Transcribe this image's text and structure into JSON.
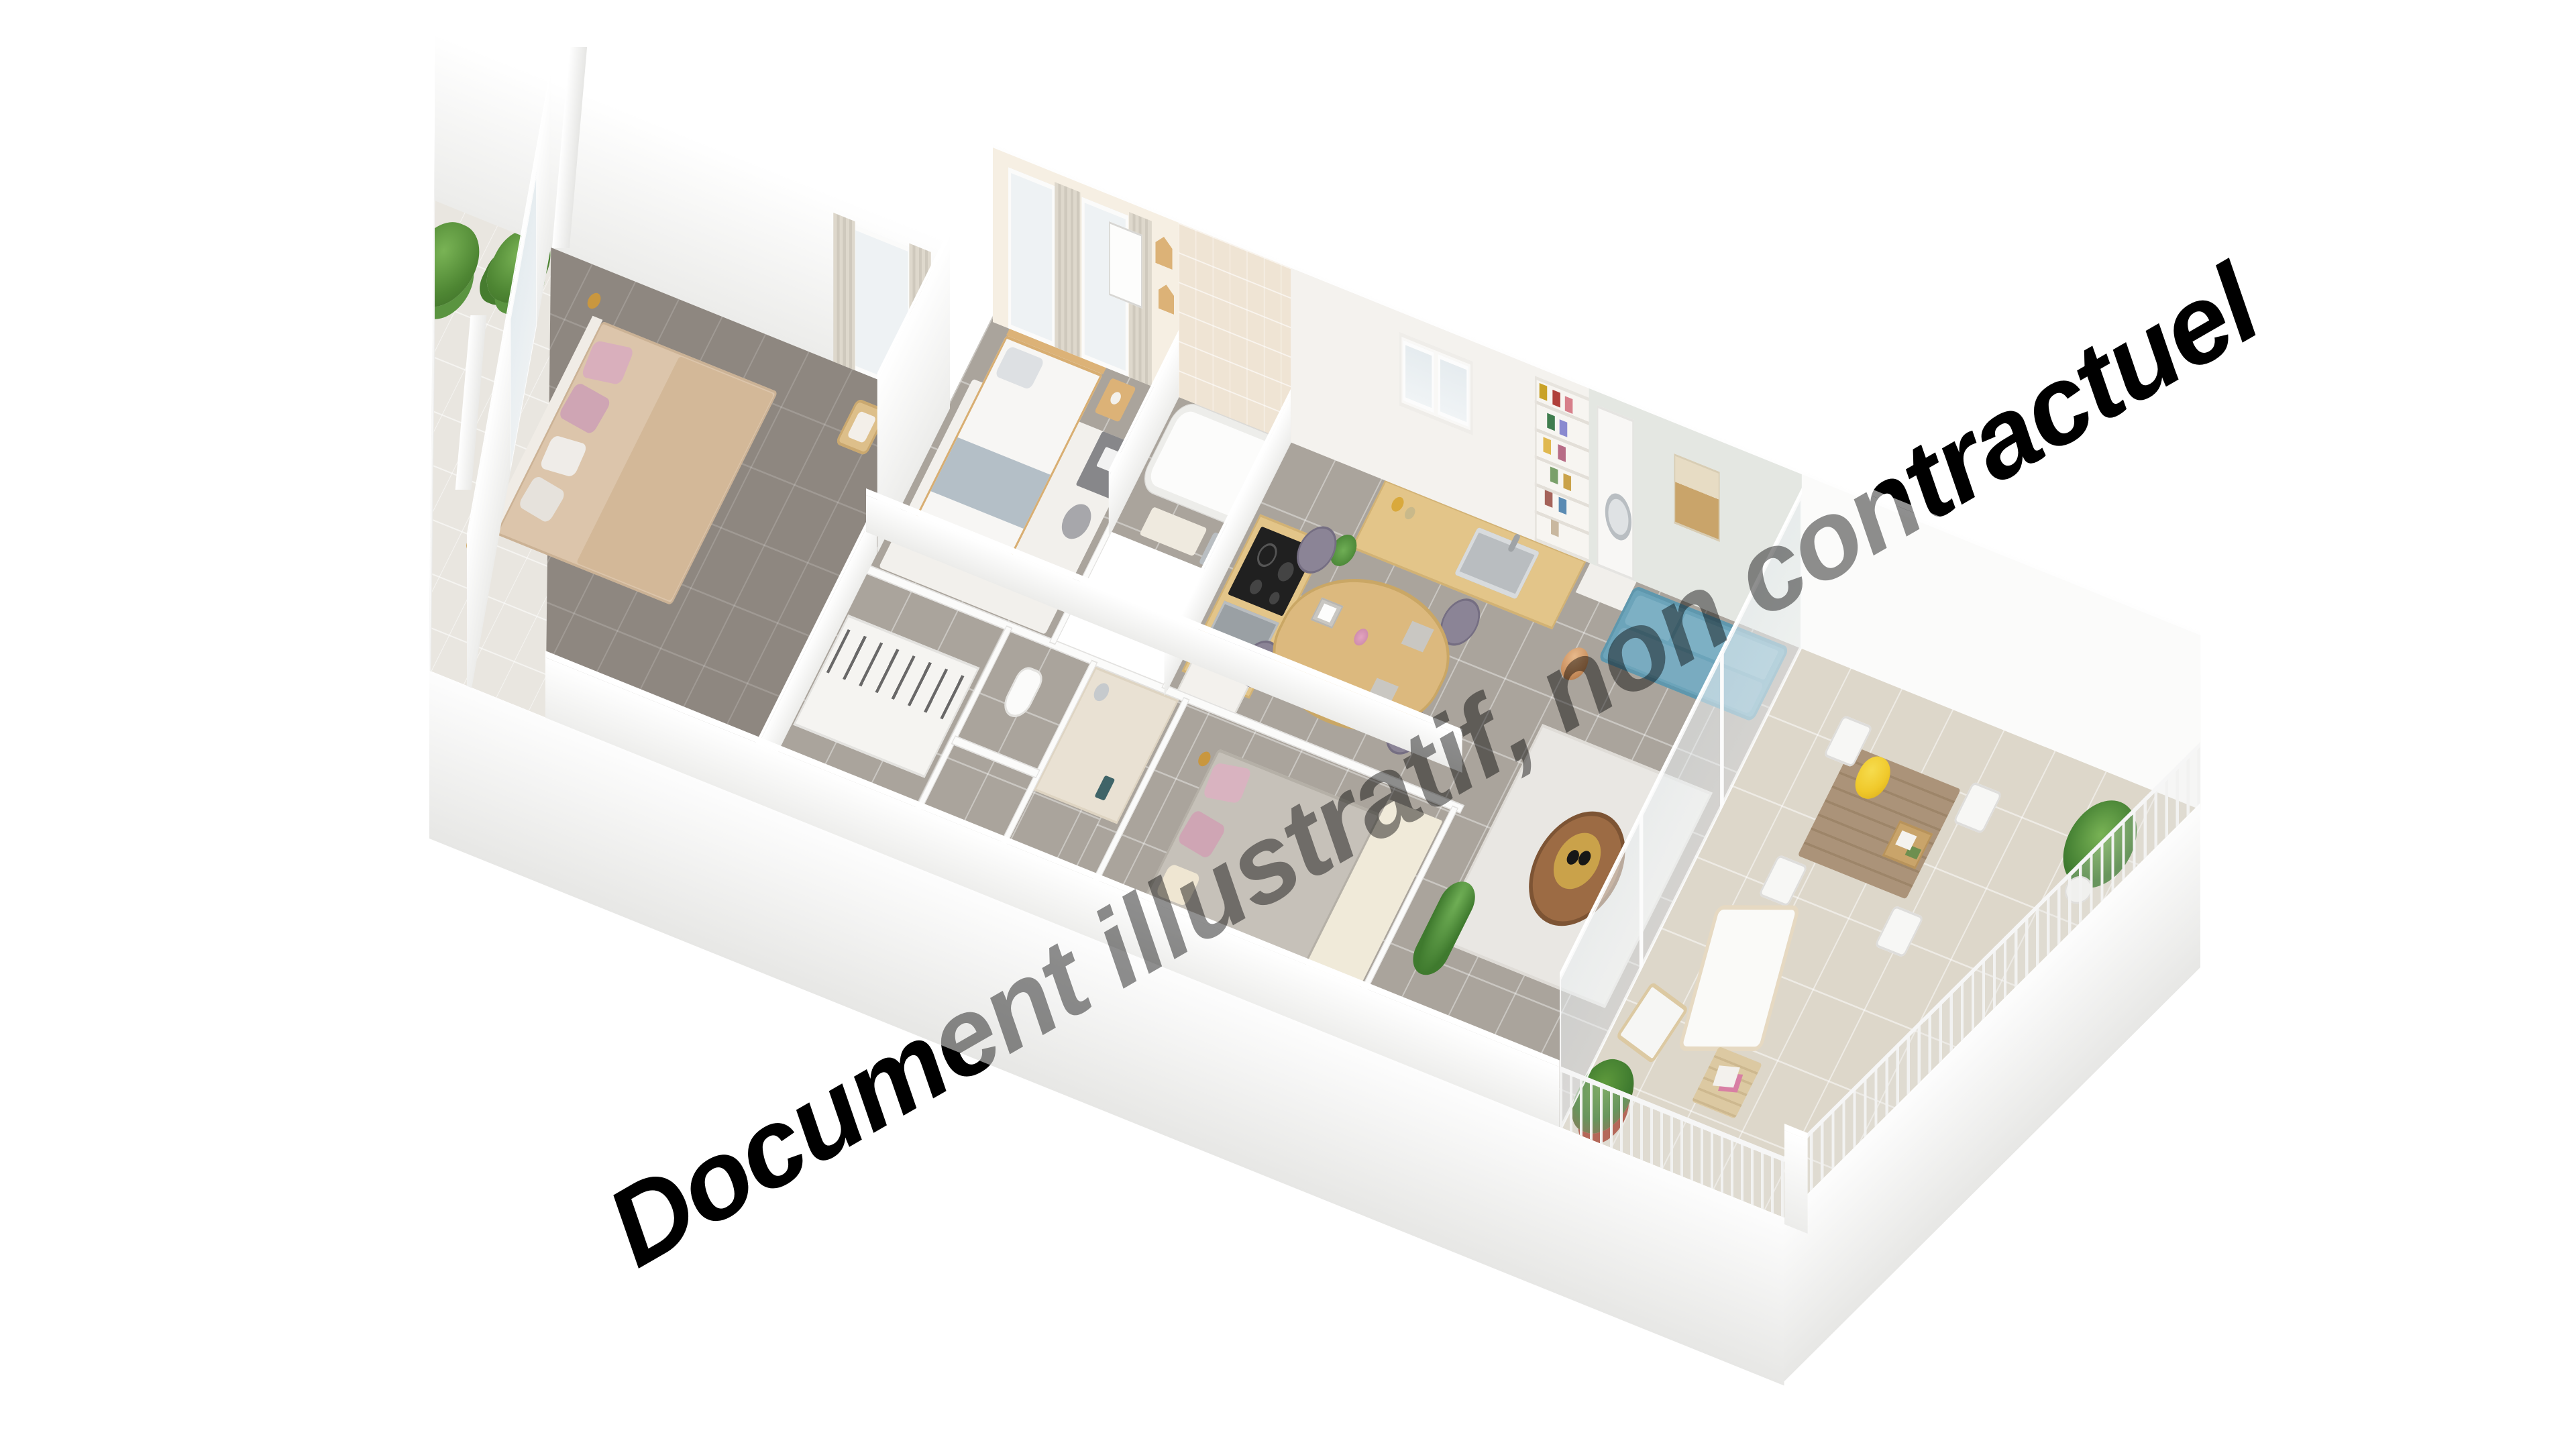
{
  "watermark": {
    "text": "Document illustratif, non contractuel",
    "color": "#000000",
    "overlay_opacity": 0.44,
    "rotation_deg": -30
  },
  "scene": {
    "type": "isometric-3d-floor-plan-render",
    "background_color": "#ffffff",
    "palette": {
      "wall_white": "#f7f7f5",
      "wall_shadow": "#e9e8e6",
      "living_wall": "#e4e7e2",
      "bedroom_wall_cream": "#f6efe3",
      "bath_wall_tile": "#efe4d4",
      "floor_tile_gray": "#aaa49c",
      "floor_tile_dark": "#8e8780",
      "terrace_tile": "#ddd7ca",
      "balcony_tile": "#e9e6e0",
      "wood_light": "#ddba82",
      "wood_walnut": "#9c6b44",
      "sofa_blue": "#6ca4ba",
      "dining_chair_gray": "#8b8496",
      "copper_lamp": "#c98f5e",
      "plant_green": "#4e8633",
      "sunflower_yellow": "#f0c92b",
      "pillow_pink": "#d9afbc",
      "bed_beige": "#dcc5ab",
      "hob_black": "#202020",
      "sink_steel": "#b9bdc0"
    },
    "rooms": [
      {
        "name": "balcony",
        "furniture": [
          "two potted trees",
          "white railing",
          "tall wall pillars",
          "tile floor"
        ]
      },
      {
        "name": "bedroom-1",
        "furniture": [
          "double bed beige blanket",
          "pink and white pillows",
          "gold floor lamps",
          "wooden chair",
          "glass door to balcony"
        ]
      },
      {
        "name": "bedroom-2",
        "furniture": [
          "single bed white duvet gray blanket",
          "wood headboard",
          "nightstand with lamp",
          "desk with laptop",
          "office chair",
          "house-shaped wall shelves",
          "europe map poster",
          "curtained windows",
          "white rug"
        ]
      },
      {
        "name": "bathroom",
        "furniture": [
          "bathtub",
          "beige tiled wall",
          "shower head",
          "bath mat",
          "gray towels"
        ]
      },
      {
        "name": "wc",
        "furniture": [
          "toilet"
        ]
      },
      {
        "name": "shower-room",
        "furniture": [
          "walk-in shower",
          "chrome shower column",
          "white towel radiator",
          "beige tiles"
        ]
      },
      {
        "name": "hallway",
        "furniture": [
          "wardrobe closets with hanging clothes",
          "teal coat hook"
        ]
      },
      {
        "name": "kitchen",
        "furniture": [
          "L-shaped counter wood top",
          "black induction hob",
          "stainless oven",
          "stainless sink with faucet",
          "white fridge",
          "glass-front wall cabinet with glasses",
          "storage jars",
          "green plant in white pot"
        ]
      },
      {
        "name": "dining-area",
        "furniture": [
          "oval light-wood table",
          "4 gray upholstered chairs gold legs",
          "white plates on gray placemats",
          "vase with pink flowers"
        ]
      },
      {
        "name": "living-room",
        "furniture": [
          "blue 3-seat sofa wooden legs",
          "white rug",
          "round walnut coffee table with gold tray",
          "copper arc floor lamp",
          "macrame wall hanging",
          "tall white bookshelf with colorful objects",
          "laundry appliance niche",
          "dark TV sideboard",
          "trailing plant"
        ]
      },
      {
        "name": "bedroom-3",
        "furniture": [
          "double bed gray cover",
          "pink pillows",
          "gold wall lamps",
          "cream rug"
        ]
      },
      {
        "name": "terrace",
        "furniture": [
          "wooden dining table",
          "sunflower bouquet in white vase",
          "serving tray with books and coffee",
          "white wire chairs",
          "white sling lounge chair",
          "folding director chair",
          "wooden side table with magazines",
          "croton plant",
          "potted palm in white planter",
          "white railing",
          "sliding glass doors"
        ]
      }
    ]
  }
}
